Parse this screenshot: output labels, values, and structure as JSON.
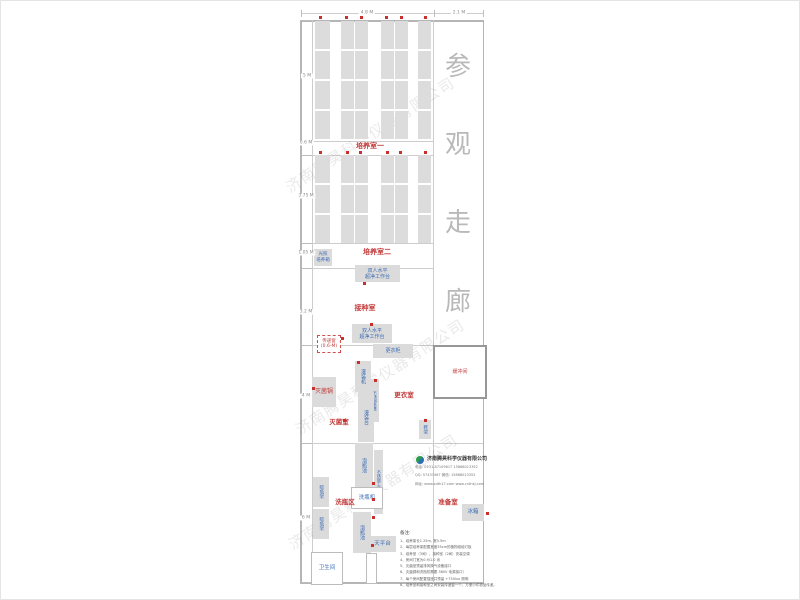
{
  "watermark": {
    "text": "济南腾昊科学仪器有限公司"
  },
  "corridor": {
    "chars": [
      "参",
      "观",
      "走",
      "廊"
    ],
    "y": [
      46,
      124,
      202,
      281
    ]
  },
  "dimensions": {
    "top": [
      {
        "label": "4.8 M",
        "cx": 367,
        "cy": 13
      },
      {
        "label": "2.1 M",
        "cx": 459,
        "cy": 13
      }
    ],
    "left": [
      {
        "label": "5 M",
        "cx": 307,
        "cy": 76
      },
      {
        "label": "0.6 M",
        "cx": 306,
        "cy": 143
      },
      {
        "label": "3.75 M",
        "cx": 306,
        "cy": 196
      },
      {
        "label": "1.05 M",
        "cx": 306,
        "cy": 253
      },
      {
        "label": "3.2 M",
        "cx": 306,
        "cy": 312
      },
      {
        "label": "4 M",
        "cx": 306,
        "cy": 396
      },
      {
        "label": "6 M",
        "cx": 306,
        "cy": 518
      }
    ]
  },
  "plan": {
    "racks": {
      "sections": [
        {
          "y": 21,
          "h": 120
        },
        {
          "y": 155,
          "h": 88
        }
      ],
      "columns": [
        {
          "x": 315,
          "w": 15
        },
        {
          "x": 341,
          "w": 13
        },
        {
          "x": 355,
          "w": 13
        },
        {
          "x": 381,
          "w": 13
        },
        {
          "x": 395,
          "w": 13
        },
        {
          "x": 418,
          "w": 13
        }
      ]
    },
    "rooms": [
      {
        "name": "culture-room-1",
        "label": "培养室一",
        "x": 370,
        "y": 146,
        "fs": 7
      },
      {
        "name": "culture-room-2",
        "label": "培养室二",
        "x": 377,
        "y": 252,
        "fs": 7
      },
      {
        "name": "inoculation-room",
        "label": "接种室",
        "x": 365,
        "y": 308,
        "fs": 7
      },
      {
        "name": "sterilization-room",
        "label": "灭菌室",
        "x": 339,
        "y": 421,
        "fs": 6.5
      },
      {
        "name": "changing-room",
        "label": "更衣室",
        "x": 404,
        "y": 394,
        "fs": 6.5
      },
      {
        "name": "bottle-washing-area",
        "label": "洗瓶区",
        "x": 345,
        "y": 501,
        "fs": 6.5
      },
      {
        "name": "preparation-room",
        "label": "准备室",
        "x": 448,
        "y": 501,
        "fs": 6.5
      }
    ],
    "equipment": [
      {
        "name": "buffer-room",
        "cls": "od redt",
        "lines": [
          "缓冲间"
        ],
        "x": 433,
        "y": 345,
        "w": 50,
        "h": 50,
        "fs": 5
      },
      {
        "name": "light-incubator",
        "cls": "g",
        "lines": [
          "光照",
          "培养箱"
        ],
        "x": 314,
        "y": 249,
        "w": 18,
        "h": 17,
        "fs": 4.5
      },
      {
        "name": "clean-bench-1",
        "cls": "g",
        "lines": [
          "双人水平",
          "超净工作台"
        ],
        "x": 355,
        "y": 265,
        "w": 45,
        "h": 17,
        "fs": 5
      },
      {
        "name": "clean-bench-2",
        "cls": "g",
        "lines": [
          "双人水平",
          "超净工作台"
        ],
        "x": 352,
        "y": 324,
        "w": 40,
        "h": 19,
        "fs": 5
      },
      {
        "name": "pass-through-window",
        "cls": "dashed redt",
        "lines": [
          "传递窗",
          "(0.6-M)"
        ],
        "x": 317,
        "y": 335,
        "w": 22,
        "h": 16,
        "fs": 4.5
      },
      {
        "name": "wardrobe",
        "cls": "g",
        "lines": [
          "更衣柜"
        ],
        "x": 373,
        "y": 344,
        "w": 40,
        "h": 14,
        "fs": 5
      },
      {
        "name": "filling-machine",
        "cls": "g v",
        "lines": [
          "灌装机"
        ],
        "x": 355,
        "y": 361,
        "w": 16,
        "h": 31,
        "fs": 5
      },
      {
        "name": "stainless-bench",
        "cls": "g v",
        "lines": [
          "不锈钢条凳"
        ],
        "x": 370,
        "y": 379,
        "w": 9,
        "h": 43,
        "fs": 4
      },
      {
        "name": "filling-table",
        "cls": "g v",
        "lines": [
          "灌装台"
        ],
        "x": 358,
        "y": 392,
        "w": 16,
        "h": 50,
        "fs": 5
      },
      {
        "name": "sterilizer-pot",
        "cls": "g redt",
        "lines": [
          "灭菌锅"
        ],
        "x": 312,
        "y": 377,
        "w": 24,
        "h": 30,
        "fs": 6
      },
      {
        "name": "shoe-rack",
        "cls": "g v",
        "lines": [
          "鞋架"
        ],
        "x": 419,
        "y": 420,
        "w": 12,
        "h": 19,
        "fs": 4.5
      },
      {
        "name": "soaking-pool-1",
        "cls": "g v",
        "lines": [
          "泡瓶池"
        ],
        "x": 355,
        "y": 443,
        "w": 18,
        "h": 44,
        "fs": 5
      },
      {
        "name": "stainless-worktable",
        "cls": "g v",
        "lines": [
          "不锈钢工作台"
        ],
        "x": 374,
        "y": 450,
        "w": 9,
        "h": 64,
        "fs": 4
      },
      {
        "name": "bottle-washer",
        "cls": "o",
        "lines": [
          "洗瓶机"
        ],
        "x": 351,
        "y": 487,
        "w": 30,
        "h": 20,
        "fs": 5.5
      },
      {
        "name": "soaking-pool-2",
        "cls": "g v",
        "lines": [
          "泡瓶池"
        ],
        "x": 353,
        "y": 512,
        "w": 18,
        "h": 41,
        "fs": 5
      },
      {
        "name": "bottle-drying-rack-1",
        "cls": "g v",
        "lines": [
          "晾瓶架"
        ],
        "x": 313,
        "y": 477,
        "w": 16,
        "h": 30,
        "fs": 4.5
      },
      {
        "name": "bottle-drying-rack-2",
        "cls": "g v",
        "lines": [
          "晾瓶架"
        ],
        "x": 313,
        "y": 509,
        "w": 16,
        "h": 30,
        "fs": 4.5
      },
      {
        "name": "balance-table",
        "cls": "g",
        "lines": [
          "天平台"
        ],
        "x": 369,
        "y": 536,
        "w": 27,
        "h": 16,
        "fs": 5.5
      },
      {
        "name": "fridge",
        "cls": "g",
        "lines": [
          "冰箱"
        ],
        "x": 462,
        "y": 504,
        "w": 22,
        "h": 17,
        "fs": 5.5
      },
      {
        "name": "toilet",
        "cls": "o",
        "lines": [
          "卫生间"
        ],
        "x": 311,
        "y": 552,
        "w": 30,
        "h": 31,
        "fs": 5.5
      },
      {
        "name": "door-leaf",
        "cls": "o",
        "lines": [],
        "x": 366,
        "y": 553,
        "w": 9,
        "h": 29,
        "fs": 4
      }
    ],
    "red_dots": [
      [
        319,
        16
      ],
      [
        345,
        16
      ],
      [
        360,
        16
      ],
      [
        385,
        16
      ],
      [
        400,
        16
      ],
      [
        424,
        16
      ],
      [
        319,
        151
      ],
      [
        346,
        151
      ],
      [
        359,
        151
      ],
      [
        386,
        151
      ],
      [
        399,
        151
      ],
      [
        424,
        151
      ],
      [
        363,
        282
      ],
      [
        370,
        323
      ],
      [
        341,
        337
      ],
      [
        357,
        361
      ],
      [
        374,
        379
      ],
      [
        312,
        387
      ],
      [
        343,
        419
      ],
      [
        424,
        419
      ],
      [
        372,
        482
      ],
      [
        372,
        498
      ],
      [
        372,
        516
      ],
      [
        371,
        544
      ],
      [
        486,
        512
      ]
    ]
  },
  "company": {
    "name": "济南腾昊科学仪器有限公司",
    "line1": "电话: 0531-87109617  15866013352",
    "line2": "QQ: 57437467   微信: 15866013352",
    "line3": "网址: www.sdth17.com   www.cnthkj.com"
  },
  "notes": {
    "title": "备注:",
    "items": [
      "1、培养架长1.25m, 宽0.5m",
      "2、每层培养架配置宽度35cm的植物组培灯板",
      "3、培养室（3间）、接种室（2间）安装空调",
      "4、房间门宽为0.9/1.0 米",
      "5、灭菌室预留排风换气设备接口",
      "6、灭菌锅和洗瓶机需要 380V 电源接口）",
      "7、每个房间配置插座并预留 +750lux 照明",
      "8、培养室和接种室之间安装传递窗一个，方便小件物品传递。"
    ]
  }
}
